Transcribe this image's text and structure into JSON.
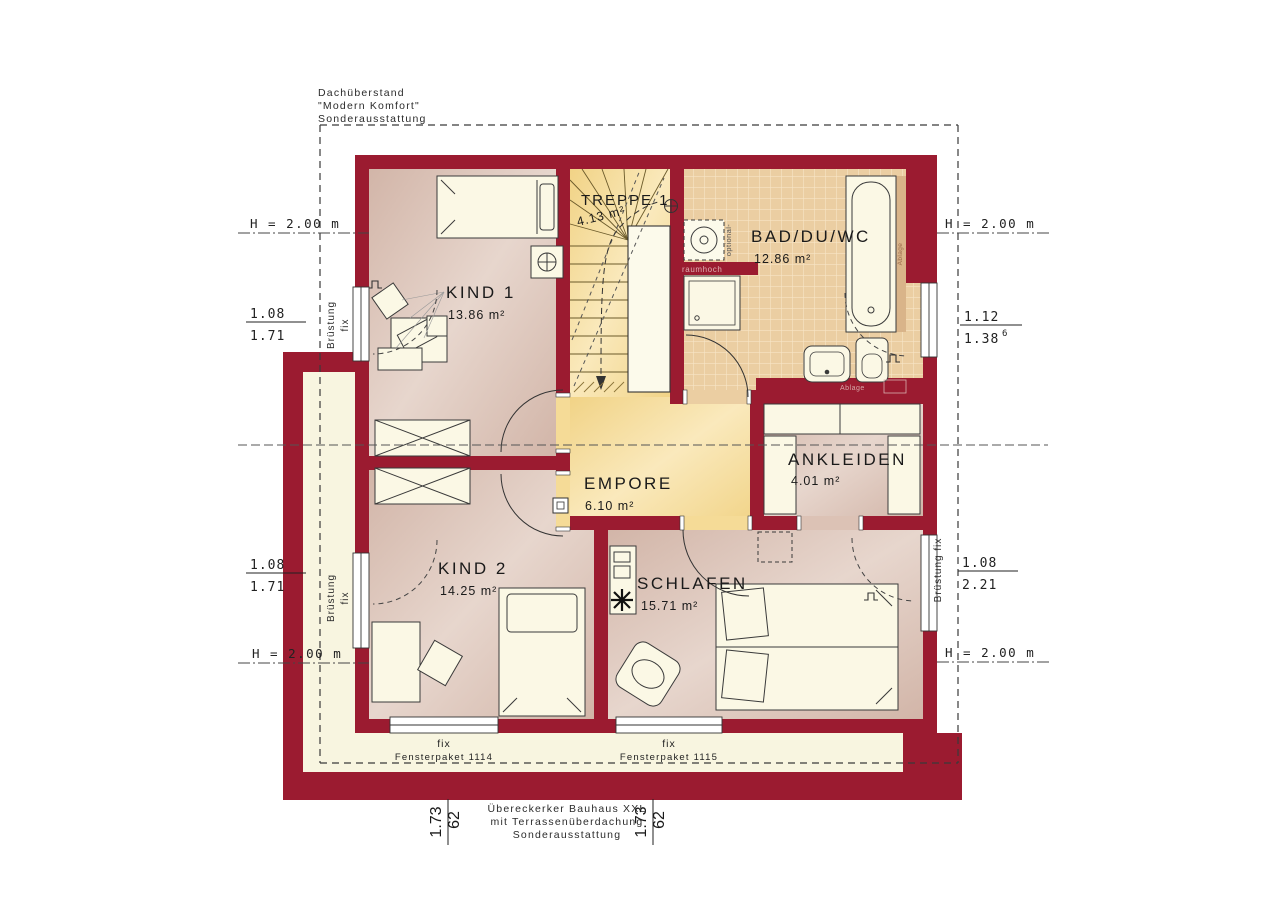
{
  "annotations": {
    "roof": {
      "line1": "Dachüberstand",
      "line2": "\"Modern Komfort\"",
      "line3": "Sonderausstattung"
    },
    "terrace": {
      "line1": "Übereckerker Bauhaus XXL",
      "line2": "mit Terrassenüberdachung",
      "line3": "Sonderausstattung"
    }
  },
  "rooms": {
    "kind1": {
      "name": "KIND 1",
      "area": "13.86 m²"
    },
    "kind2": {
      "name": "KIND 2",
      "area": "14.25 m²"
    },
    "schlafen": {
      "name": "SCHLAFEN",
      "area": "15.71 m²"
    },
    "bad": {
      "name": "BAD/DU/WC",
      "area": "12.86 m²"
    },
    "empore": {
      "name": "EMPORE",
      "area": "6.10 m²"
    },
    "ankleiden": {
      "name": "ANKLEIDEN",
      "area": "4.01 m²"
    },
    "treppe": {
      "name": "TREPPE 1",
      "area": "4.13 m²"
    }
  },
  "heights": {
    "top_left": "H = 2.00 m",
    "top_right": "H = 2.00 m",
    "bottom_left": "H = 2.00 m",
    "bottom_right": "H = 2.00 m"
  },
  "windows": {
    "left_top": {
      "width": "1.08",
      "height": "1.71",
      "note_line1": "Brüstung",
      "note_line2": "fix"
    },
    "left_bottom": {
      "width": "1.08",
      "height": "1.71",
      "note_line1": "Brüstung",
      "note_line2": "fix"
    },
    "right_top": {
      "width": "1.12",
      "height": "1.38",
      "height_sup": "6"
    },
    "right_bottom": {
      "width": "1.08",
      "height": "2.21",
      "note": "Brüstung fix"
    },
    "bottom_left_pack": {
      "type": "fix",
      "pack": "Fensterpaket 1114"
    },
    "bottom_right_pack": {
      "type": "fix",
      "pack": "Fensterpaket 1115"
    }
  },
  "eaves_dims": {
    "left": {
      "a": "1.73",
      "b": "62"
    },
    "right": {
      "a": "1.73",
      "b": "62"
    }
  },
  "labels": {
    "raumhoch": "raumhoch",
    "optional": "optional-",
    "ablage_tub": "Ablage",
    "ablage_wc": "Ablage"
  },
  "colors": {
    "wall": "#9B1B30",
    "room_pink": "#D9BEB2",
    "stair_yellow": "#F5DB97",
    "tile": "#EBCEA2",
    "terrace_cream": "#F8F5E0",
    "furniture": "#FBF8E5"
  }
}
